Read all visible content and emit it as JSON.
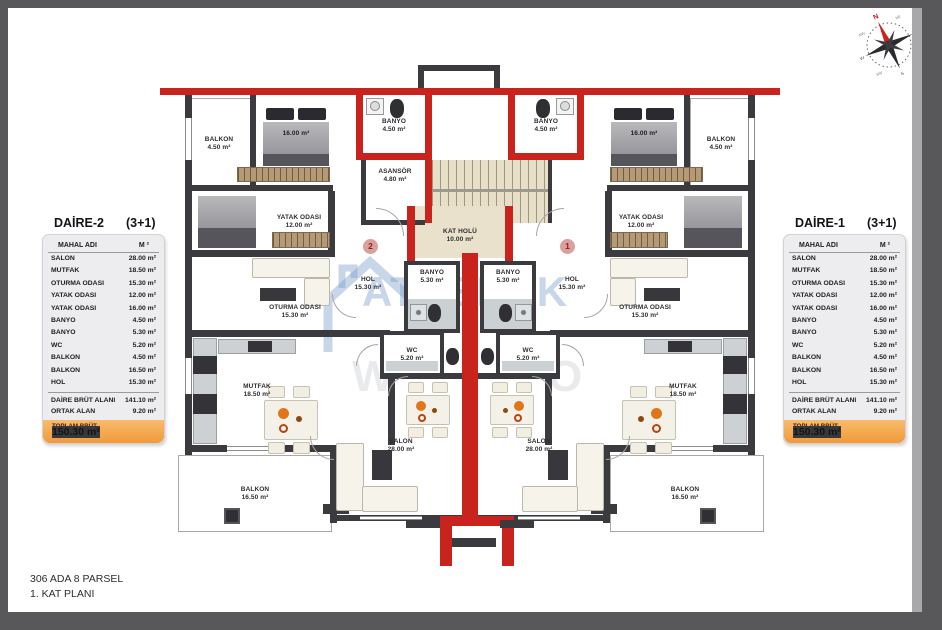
{
  "footer": {
    "line1": "306 ADA 8 PARSEL",
    "line2": "1. KAT PLANI"
  },
  "watermark": {
    "brand": "ATABERK",
    "letter_left": "W",
    "letter_right": "O"
  },
  "compass": {
    "n": "N",
    "ne": "NE",
    "e": "E",
    "se": "SE",
    "s": "S",
    "sw": "SW",
    "w": "W",
    "nw": "NW"
  },
  "colors": {
    "wall": "#3b3b3f",
    "red_wall": "#c9231e",
    "total_bar": "#f4a74e"
  },
  "tables": {
    "left": {
      "title": "DAİRE-2",
      "type": "(3+1)",
      "col_name": "MAHAL ADI",
      "col_area": "M ²",
      "rows": [
        {
          "name": "SALON",
          "area": "28.00 m²"
        },
        {
          "name": "MUTFAK",
          "area": "18.50 m²"
        },
        {
          "name": "OTURMA ODASI",
          "area": "15.30 m²"
        },
        {
          "name": "YATAK ODASI",
          "area": "12.00 m²"
        },
        {
          "name": "YATAK ODASI",
          "area": "16.00 m²"
        },
        {
          "name": "BANYO",
          "area": "4.50 m²"
        },
        {
          "name": "BANYO",
          "area": "5.30 m²"
        },
        {
          "name": "WC",
          "area": "5.20 m²"
        },
        {
          "name": "BALKON",
          "area": "4.50 m²"
        },
        {
          "name": "BALKON",
          "area": "16.50 m²"
        },
        {
          "name": "HOL",
          "area": "15.30 m²"
        }
      ],
      "summary": [
        {
          "name": "DAİRE BRÜT ALANI",
          "area": "141.10 m²"
        },
        {
          "name": "ORTAK ALAN",
          "area": "9.20 m²"
        }
      ],
      "total_label": "TOPLAM BRÜT ALAN",
      "total_value": "150.30 m²"
    },
    "right": {
      "title": "DAİRE-1",
      "type": "(3+1)",
      "col_name": "MAHAL ADI",
      "col_area": "M ²",
      "rows": [
        {
          "name": "SALON",
          "area": "28.00 m²"
        },
        {
          "name": "MUTFAK",
          "area": "18.50 m²"
        },
        {
          "name": "OTURMA ODASI",
          "area": "15.30 m²"
        },
        {
          "name": "YATAK ODASI",
          "area": "12.00 m²"
        },
        {
          "name": "YATAK ODASI",
          "area": "16.00 m²"
        },
        {
          "name": "BANYO",
          "area": "4.50 m²"
        },
        {
          "name": "BANYO",
          "area": "5.30 m²"
        },
        {
          "name": "WC",
          "area": "5.20 m²"
        },
        {
          "name": "BALKON",
          "area": "4.50 m²"
        },
        {
          "name": "BALKON",
          "area": "16.50 m²"
        },
        {
          "name": "HOL",
          "area": "15.30 m²"
        }
      ],
      "summary": [
        {
          "name": "DAİRE BRÜT ALANI",
          "area": "141.10 m²"
        },
        {
          "name": "ORTAK ALAN",
          "area": "9.20 m²"
        }
      ],
      "total_label": "TOPLAM BRÜT ALAN",
      "total_value": "150.30 m²"
    }
  },
  "plan": {
    "units": {
      "left": "2",
      "right": "1"
    },
    "rooms": {
      "balkon_tl": {
        "name": "BALKON",
        "area": "4.50 m²"
      },
      "balkon_tr": {
        "name": "BALKON",
        "area": "4.50 m²"
      },
      "bed16_l": {
        "area": "16.00 m²"
      },
      "bed16_r": {
        "area": "16.00 m²"
      },
      "yatak12_l": {
        "name": "YATAK ODASI",
        "area": "12.00 m²"
      },
      "yatak12_r": {
        "name": "YATAK ODASI",
        "area": "12.00 m²"
      },
      "banyo45_l": {
        "name": "BANYO",
        "area": "4.50 m²"
      },
      "banyo45_r": {
        "name": "BANYO",
        "area": "4.50 m²"
      },
      "asansor": {
        "name": "ASANSÖR",
        "area": "4.80 m²"
      },
      "kat_holu": {
        "name": "KAT HOLÜ",
        "area": "10.00 m²"
      },
      "banyo53_l": {
        "name": "BANYO",
        "area": "5.30 m²"
      },
      "banyo53_r": {
        "name": "BANYO",
        "area": "5.30 m²"
      },
      "hol_l": {
        "name": "HOL",
        "area": "15.30 m²"
      },
      "hol_r": {
        "name": "HOL",
        "area": "15.30 m²"
      },
      "oturma_l": {
        "name": "OTURMA ODASI",
        "area": "15.30 m²"
      },
      "oturma_r": {
        "name": "OTURMA ODASI",
        "area": "15.30 m²"
      },
      "wc_l": {
        "name": "WC",
        "area": "5.20 m²"
      },
      "wc_r": {
        "name": "WC",
        "area": "5.20 m²"
      },
      "mutfak_l": {
        "name": "MUTFAK",
        "area": "18.50 m²"
      },
      "mutfak_r": {
        "name": "MUTFAK",
        "area": "18.50 m²"
      },
      "salon_l": {
        "name": "SALON",
        "area": "28.00 m²"
      },
      "salon_r": {
        "name": "SALON",
        "area": "28.00 m²"
      },
      "balkon_bl": {
        "name": "BALKON",
        "area": "16.50 m²"
      },
      "balkon_br": {
        "name": "BALKON",
        "area": "16.50 m²"
      }
    }
  }
}
